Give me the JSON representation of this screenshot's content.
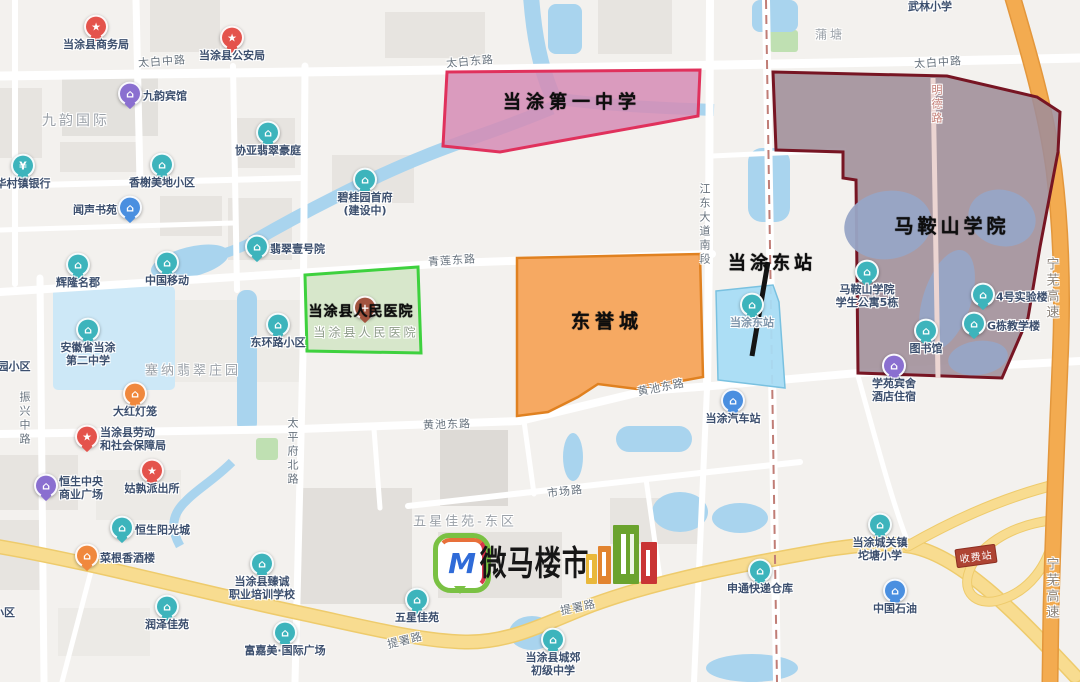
{
  "watermark": {
    "brand": "微马楼市",
    "monogram": "M"
  },
  "regions": [
    {
      "name": "当涂第一中学",
      "fill": "#d58cb5",
      "fill_opacity": 0.85,
      "stroke": "#e0315c"
    },
    {
      "name": "马鞍山学院",
      "fill": "#9f8d98",
      "fill_opacity": 0.88,
      "stroke": "#771523"
    },
    {
      "name": "当涂县人民医院",
      "fill": "#cfe5c2",
      "fill_opacity": 0.8,
      "stroke": "#3ed13e"
    },
    {
      "name": "东誉城",
      "fill": "#f5a45a",
      "fill_opacity": 0.95,
      "stroke": "#e08120"
    },
    {
      "name": "当涂东站",
      "fill": "#a8dcf4",
      "fill_opacity": 0.95,
      "stroke": "#79c1e0"
    }
  ],
  "calligraphy": [
    {
      "t": "当涂第一中学",
      "x": 572,
      "y": 101,
      "s": 18,
      "ls": 5
    },
    {
      "t": "马鞍山学院",
      "x": 952,
      "y": 225,
      "s": 19,
      "ls": 4
    },
    {
      "t": "当涂县人民医院",
      "x": 361,
      "y": 311,
      "s": 14,
      "ls": 1
    },
    {
      "t": "东誉城",
      "x": 607,
      "y": 320,
      "s": 19,
      "ls": 5
    },
    {
      "t": "当涂东站",
      "x": 772,
      "y": 262,
      "s": 18,
      "ls": 4
    }
  ],
  "area_labels": [
    {
      "t": "九韵国际",
      "x": 76,
      "y": 120,
      "s": 14
    },
    {
      "t": "蒲塘",
      "x": 830,
      "y": 34,
      "s": 12
    },
    {
      "t": "塞纳翡翠庄园",
      "x": 193,
      "y": 369,
      "s": 13
    },
    {
      "t": "五星佳苑-东区",
      "x": 465,
      "y": 520,
      "s": 13
    },
    {
      "t": "当涂县人民医院",
      "x": 366,
      "y": 332,
      "s": 12,
      "c": "#8d9b88"
    }
  ],
  "road_labels": [
    {
      "t": "太白中路",
      "x": 162,
      "y": 61,
      "r": -4
    },
    {
      "t": "太白东路",
      "x": 470,
      "y": 61,
      "r": -5
    },
    {
      "t": "太白中路",
      "x": 938,
      "y": 62,
      "r": -4
    },
    {
      "t": "青莲东路",
      "x": 452,
      "y": 260,
      "r": -4
    },
    {
      "t": "黄池东路",
      "x": 447,
      "y": 424,
      "r": -2
    },
    {
      "t": "黄池东路",
      "x": 661,
      "y": 387,
      "r": -11
    },
    {
      "t": "市场路",
      "x": 565,
      "y": 491,
      "r": -7
    },
    {
      "t": "提署路",
      "x": 405,
      "y": 640,
      "r": -14
    },
    {
      "t": "提署路",
      "x": 578,
      "y": 607,
      "r": -12
    },
    {
      "t": "振兴中路",
      "x": 24,
      "y": 419,
      "v": 1
    },
    {
      "t": "太平府北路",
      "x": 292,
      "y": 452,
      "v": 1
    },
    {
      "t": "江东大道南段",
      "x": 704,
      "y": 225,
      "v": 1
    },
    {
      "t": "明德路",
      "x": 936,
      "y": 105,
      "v": 1,
      "c": "#c47e76"
    },
    {
      "t": "宁芜高速",
      "x": 1051,
      "y": 289,
      "v": 1,
      "c": "#8a8178",
      "s": 13
    },
    {
      "t": "宁芜高速",
      "x": 1051,
      "y": 589,
      "v": 1,
      "c": "#8a8178",
      "s": 13
    }
  ],
  "pois": [
    {
      "t": [
        "当涂县商务局"
      ],
      "p": [
        96,
        29
      ],
      "c": "red",
      "g": "★",
      "lp": "below"
    },
    {
      "t": [
        "当涂县公安局"
      ],
      "p": [
        232,
        40
      ],
      "c": "red",
      "g": "★",
      "lp": "below"
    },
    {
      "t": [
        "九韵宾馆"
      ],
      "p": [
        130,
        96
      ],
      "c": "purple",
      "g": "⌂",
      "lp": "right"
    },
    {
      "t": [
        "协亚翡翠豪庭"
      ],
      "p": [
        268,
        135
      ],
      "c": "teal",
      "g": "⌂",
      "lp": "below"
    },
    {
      "t": [
        "华村镇银行"
      ],
      "p": [
        23,
        168
      ],
      "c": "teal",
      "g": "¥",
      "lp": "below"
    },
    {
      "t": [
        "香榭美地小区"
      ],
      "p": [
        162,
        167
      ],
      "c": "teal",
      "g": "⌂",
      "lp": "below"
    },
    {
      "t": [
        "闻声书苑"
      ],
      "p": [
        130,
        210
      ],
      "c": "blue",
      "g": "⌂",
      "lp": "left"
    },
    {
      "t": [
        "碧桂园首府",
        "(建设中)"
      ],
      "p": [
        365,
        182
      ],
      "c": "teal",
      "g": "⌂",
      "lp": "below"
    },
    {
      "t": [
        "翡翠壹号院"
      ],
      "p": [
        257,
        249
      ],
      "c": "teal",
      "g": "⌂",
      "lp": "right"
    },
    {
      "t": [
        "辉隆名郡"
      ],
      "p": [
        78,
        267
      ],
      "c": "teal",
      "g": "⌂",
      "lp": "below"
    },
    {
      "t": [
        "中国移动"
      ],
      "p": [
        167,
        265
      ],
      "c": "teal",
      "g": "⌂",
      "lp": "below"
    },
    {
      "t": [
        "东环路小区"
      ],
      "p": [
        278,
        327
      ],
      "c": "teal",
      "g": "⌂",
      "lp": "below"
    },
    {
      "t": [
        "安徽省当涂",
        "第二中学"
      ],
      "p": [
        88,
        332
      ],
      "c": "teal",
      "g": "⌂",
      "lp": "below"
    },
    {
      "t": [
        "大红灯笼"
      ],
      "p": [
        135,
        396
      ],
      "c": "orange",
      "g": "⌂",
      "lp": "below"
    },
    {
      "t": [
        "当涂县劳动",
        "和社会保障局"
      ],
      "p": [
        87,
        439
      ],
      "c": "red",
      "g": "★",
      "lp": "right"
    },
    {
      "t": [
        "恒生中央",
        "商业广场"
      ],
      "p": [
        46,
        488
      ],
      "c": "purple",
      "g": "⌂",
      "lp": "right"
    },
    {
      "t": [
        "姑孰派出所"
      ],
      "p": [
        152,
        473
      ],
      "c": "red",
      "g": "★",
      "lp": "below"
    },
    {
      "t": [
        "恒生阳光城"
      ],
      "p": [
        122,
        530
      ],
      "c": "teal",
      "g": "⌂",
      "lp": "right"
    },
    {
      "t": [
        "菜根香酒楼"
      ],
      "p": [
        87,
        558
      ],
      "c": "orange",
      "g": "⌂",
      "lp": "right"
    },
    {
      "t": [
        "当涂县臻诚",
        "职业培训学校"
      ],
      "p": [
        262,
        566
      ],
      "c": "teal",
      "g": "⌂",
      "lp": "below"
    },
    {
      "t": [
        "润泽佳苑"
      ],
      "p": [
        167,
        609
      ],
      "c": "teal",
      "g": "⌂",
      "lp": "below"
    },
    {
      "t": [
        "富嘉美·国际广场"
      ],
      "p": [
        285,
        635
      ],
      "c": "teal",
      "g": "⌂",
      "lp": "below"
    },
    {
      "t": [
        "五星佳苑"
      ],
      "p": [
        417,
        602
      ],
      "c": "teal",
      "g": "⌂",
      "lp": "below"
    },
    {
      "t": [
        "当涂县城郊",
        "初级中学"
      ],
      "p": [
        553,
        642
      ],
      "c": "teal",
      "g": "⌂",
      "lp": "below"
    },
    {
      "t": [
        "申通快递仓库"
      ],
      "p": [
        760,
        573
      ],
      "c": "teal",
      "g": "⌂",
      "lp": "below"
    },
    {
      "t": [
        "当涂汽车站"
      ],
      "p": [
        733,
        403
      ],
      "c": "blue",
      "g": "⌂",
      "lp": "below"
    },
    {
      "t": [
        "中国石油"
      ],
      "p": [
        895,
        593
      ],
      "c": "blue",
      "g": "⌂",
      "lp": "below"
    },
    {
      "t": [
        "当涂城关镇",
        "坨塘小学"
      ],
      "p": [
        880,
        527
      ],
      "c": "teal",
      "g": "⌂",
      "lp": "below"
    },
    {
      "t": [
        "学苑宾舍",
        "酒店住宿"
      ],
      "p": [
        894,
        368
      ],
      "c": "purple",
      "g": "⌂",
      "lp": "below"
    },
    {
      "t": [
        "马鞍山学院",
        "学生公寓5栋"
      ],
      "p": [
        867,
        274
      ],
      "c": "teal",
      "g": "⌂",
      "lp": "below"
    },
    {
      "t": [
        "4号实验楼"
      ],
      "p": [
        983,
        297
      ],
      "c": "teal",
      "g": "⌂",
      "lp": "right"
    },
    {
      "t": [
        "G栋教学楼"
      ],
      "p": [
        974,
        326
      ],
      "c": "teal",
      "g": "⌂",
      "lp": "right"
    },
    {
      "t": [
        "图书馆"
      ],
      "p": [
        926,
        333
      ],
      "c": "teal",
      "g": "⌂",
      "lp": "below"
    },
    {
      "t": [
        "当涂东站"
      ],
      "p": [
        752,
        307
      ],
      "c": "teal",
      "g": "⌂",
      "lp": "below",
      "lc": "#7e95ab"
    },
    {
      "t": [],
      "p": [
        365,
        310
      ],
      "c": "brown",
      "g": "+",
      "lp": "below"
    },
    {
      "t": [
        "武林小学"
      ],
      "p": [
        930,
        6
      ],
      "np": 1,
      "lp": "below"
    },
    {
      "t": [
        "园小区"
      ],
      "p": [
        14,
        366
      ],
      "np": 1,
      "lp": "below"
    },
    {
      "t": [
        "小区"
      ],
      "p": [
        4,
        612
      ],
      "np": 1,
      "lp": "below"
    }
  ],
  "toll_badge": {
    "text": "收费站",
    "x": 976,
    "y": 556,
    "rotation": -8
  },
  "colors": {
    "pin_palette": {
      "teal": "#3db4bc",
      "red": "#e4534c",
      "blue": "#4a8fe0",
      "purple": "#8a6fd0",
      "orange": "#f0883d",
      "brown": "#a2543f"
    },
    "land": "#f3f1ee",
    "block": "#e7e4e0",
    "park": "#bfe0b2",
    "water": "#a9d4ee",
    "water_light": "#cde8f7",
    "campus_lake": "#98a6c6",
    "road_yellow": "#f8dc90",
    "road_yellow_casing": "#eecb6c",
    "highway": "#f3ab50",
    "highway_casing": "#e3973c",
    "railway_dash": "#c07d76",
    "station_line": "#141414",
    "poi_label": "#3c4f6e"
  }
}
